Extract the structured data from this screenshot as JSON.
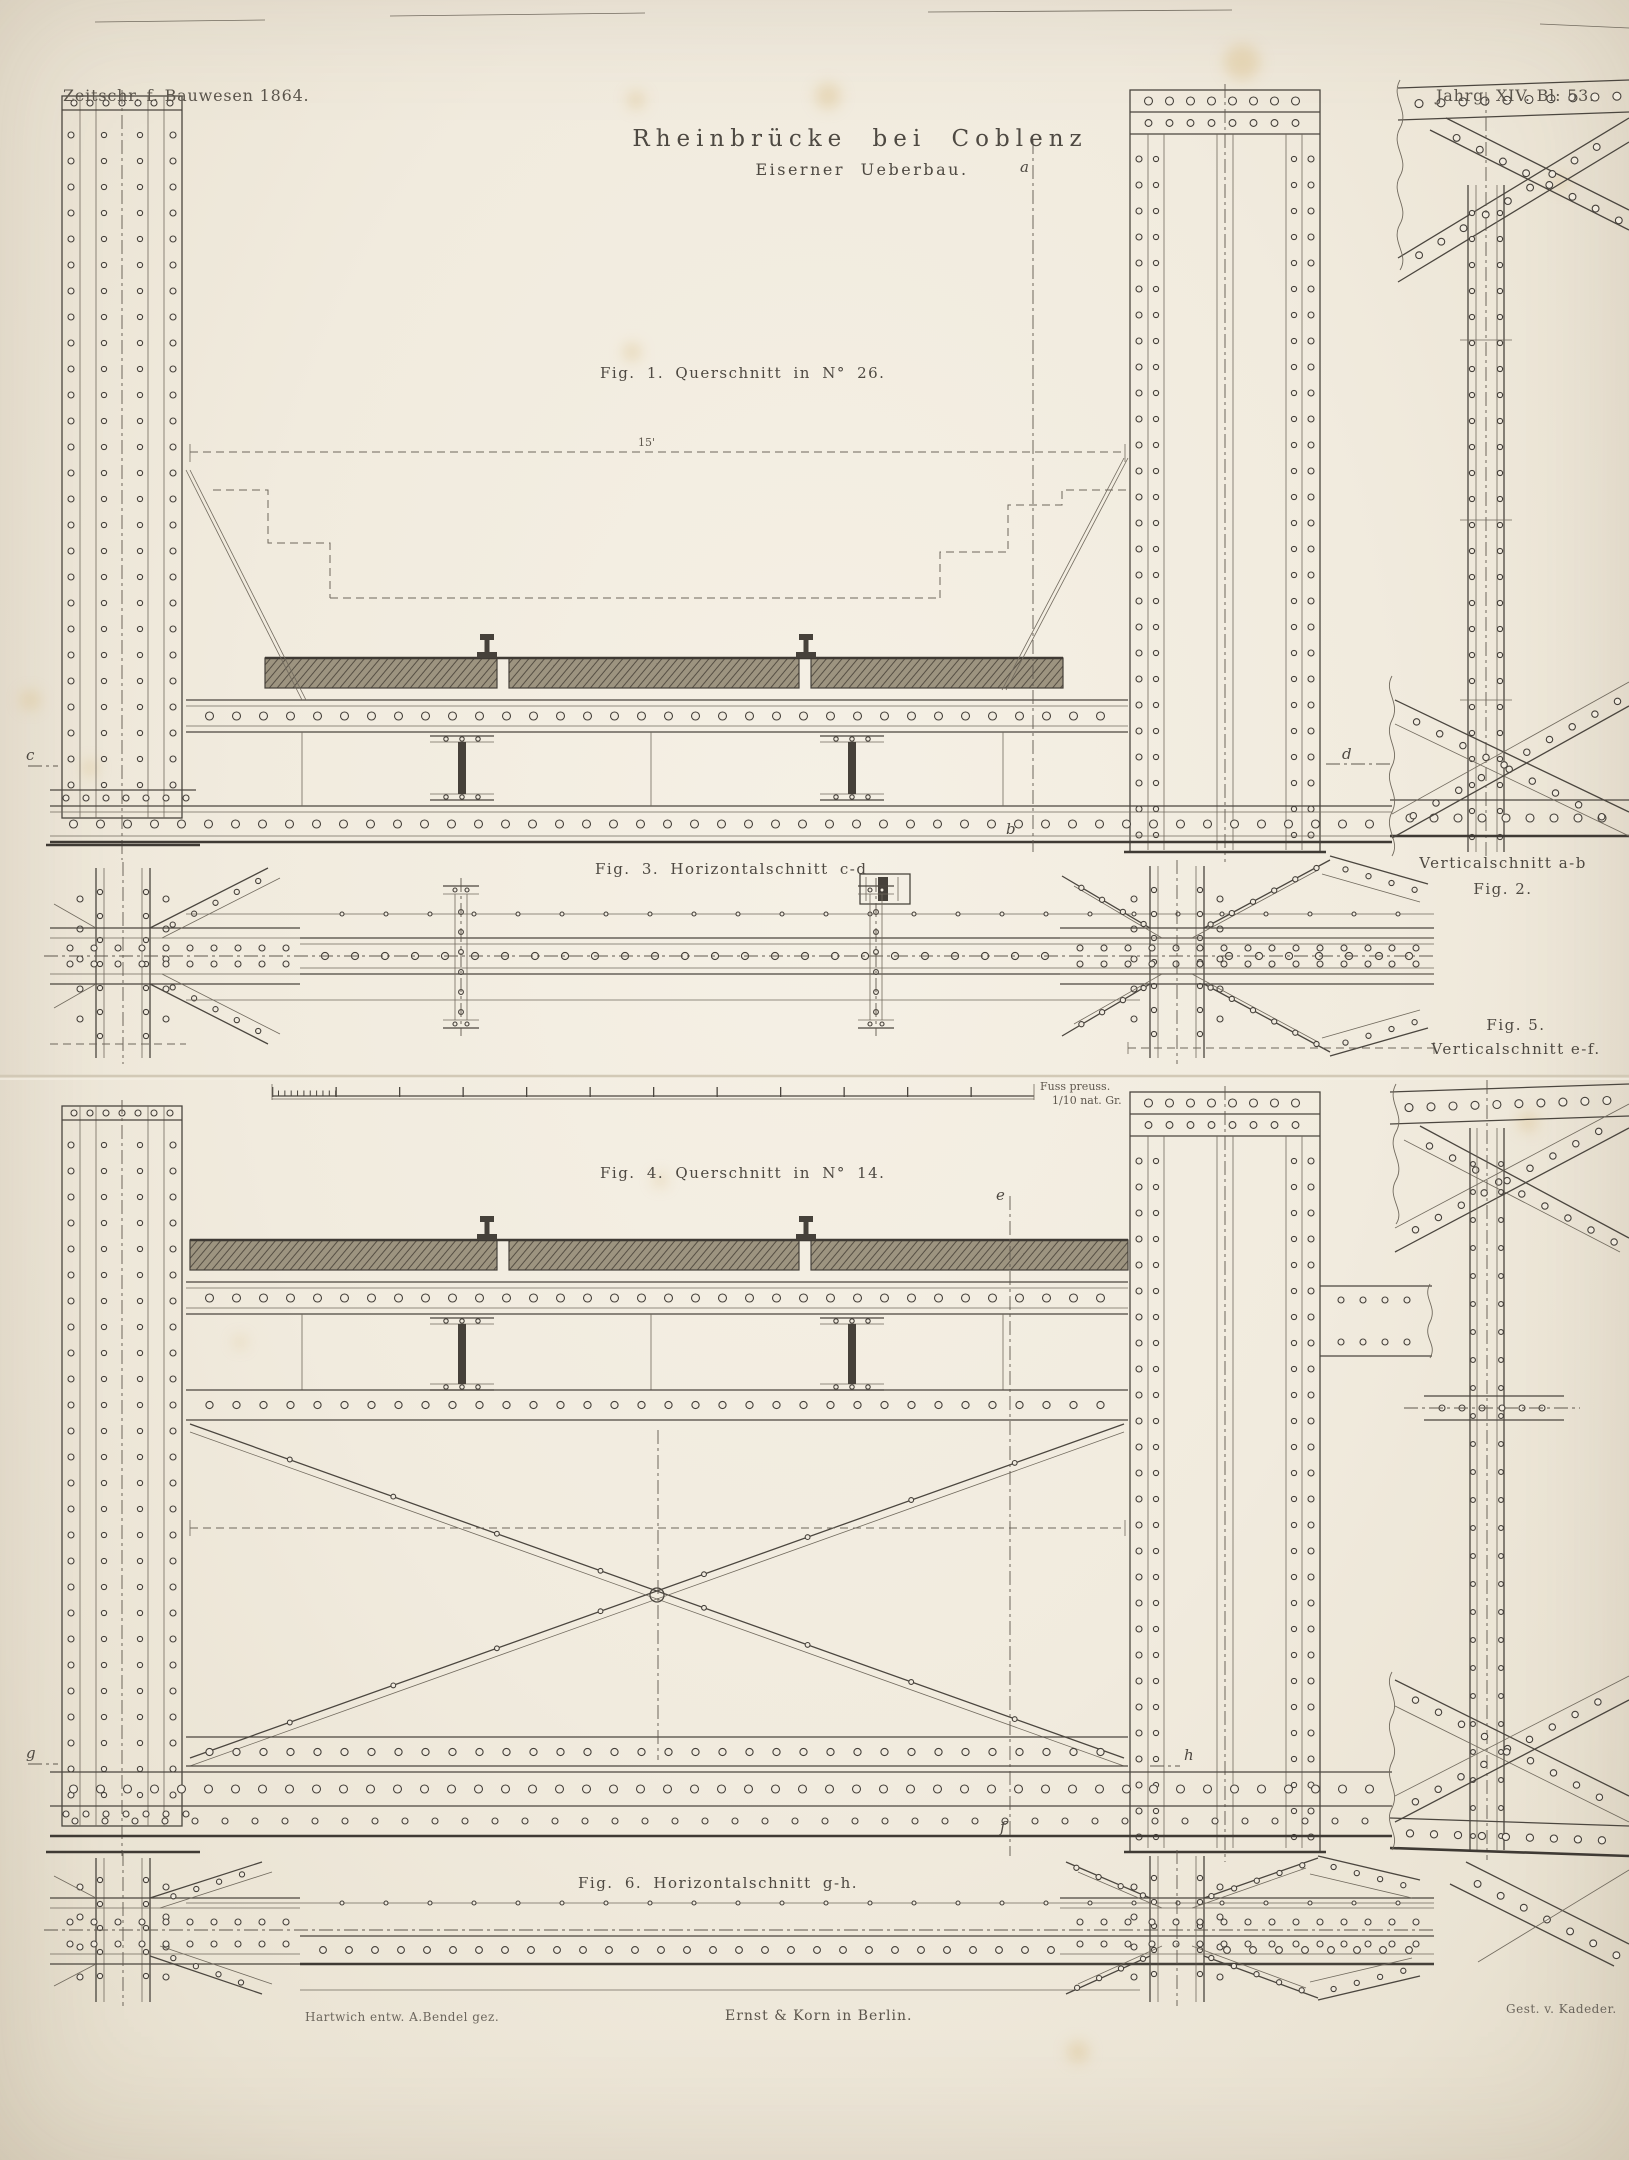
{
  "plate": {
    "journal": "Zeitschr. f. Bauwesen 1864.",
    "issue": "Jahrg. XIV. Bl: 53.",
    "title": "Rheinbrücke bei Coblenz",
    "subtitle": "Eiserner Ueberbau."
  },
  "figures": {
    "fig1": "Fig. 1. Querschnitt in N° 26.",
    "fig2_line1": "Verticalschnitt a-b",
    "fig2_line2": "Fig. 2.",
    "fig3": "Fig. 3. Horizontalschnitt c-d",
    "fig4": "Fig. 4. Querschnitt in N° 14.",
    "fig5_line1": "Fig. 5.",
    "fig5_line2": "Verticalschnitt e-f.",
    "fig6": "Fig. 6. Horizontalschnitt g-h."
  },
  "scale_bar": {
    "label_line1": "Fuss preuss.",
    "label_line2": "1/10 nat. Gr."
  },
  "dimensions": {
    "span": "15'"
  },
  "section_letters": {
    "a": "a",
    "b": "b",
    "c": "c",
    "d": "d",
    "e": "e",
    "f": "f",
    "g": "g",
    "h": "h"
  },
  "credits": {
    "designer": "Hartwich entw.  A.Bendel gez.",
    "publisher": "Ernst & Korn in Berlin.",
    "engraver": "Gest. v. Kadeder."
  }
}
